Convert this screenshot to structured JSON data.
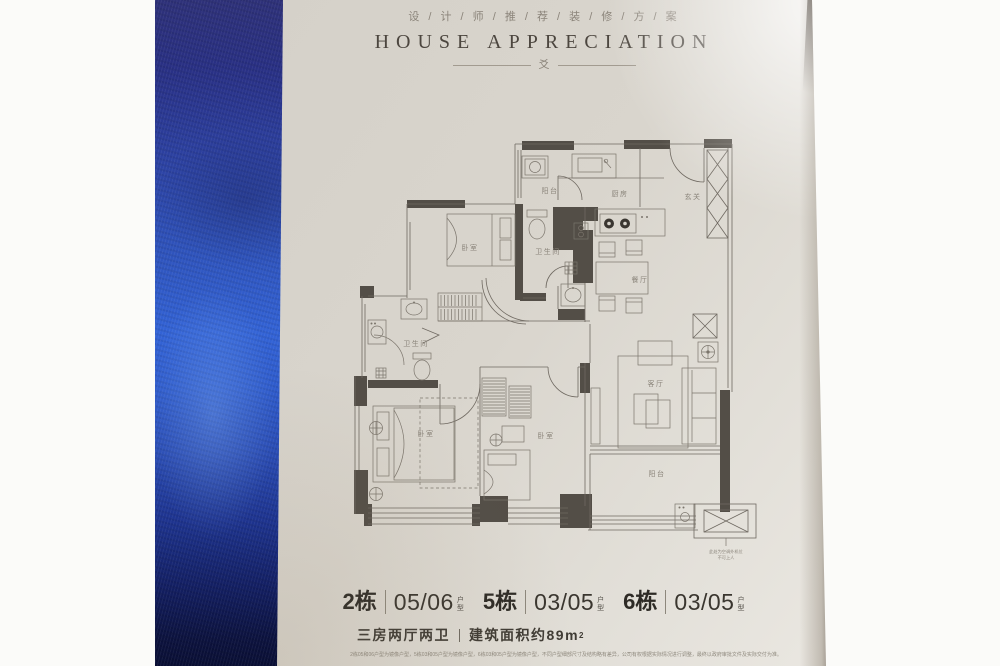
{
  "photo": {
    "header": {
      "title_cn": "设 / 计 / 师 / 推 / 荐 / 装 / 修 / 方 / 案",
      "title_en": "HOUSE APPRECIATION",
      "ornament_glyph": "爻"
    },
    "plan": {
      "rooms": {
        "balcony_top": "阳台",
        "kitchen": "厨房",
        "entry": "玄关",
        "bedroom_top": "卧室",
        "bath_inner": "卫生间",
        "dining": "餐厅",
        "bath_main": "卫生间",
        "living": "客厅",
        "bedroom_master": "卧室",
        "bedroom_second": "卧室",
        "balcony_bottom": "阳台"
      },
      "ac_note_line1": "此处为空调外机位",
      "ac_note_line2": "不可上人"
    },
    "units": [
      {
        "building": "2栋",
        "number": "05/06",
        "suffix": "户型"
      },
      {
        "building": "5栋",
        "number": "03/05",
        "suffix": "户型"
      },
      {
        "building": "6栋",
        "number": "03/05",
        "suffix": "户型"
      }
    ],
    "summary": {
      "layout": "三房两厅两卫",
      "area_text": "建筑面积约89m",
      "area_sup": "2"
    },
    "disclaimer": "2栋05和06户型为镜像户型，5栋03和05户型为镜像户型，6栋03和05户型为镜像户型，不同户型细部尺寸及结构略有差异，公司有权根据实际情况进行调整，最终以政府审批文件及实际交付为准。",
    "colors": {
      "spine_blue": "#2f54bd",
      "page_cream": "#d8d4cc",
      "wall_dark": "#534e47",
      "text_dark": "#37332d",
      "label_gray": "#8b857b"
    }
  }
}
